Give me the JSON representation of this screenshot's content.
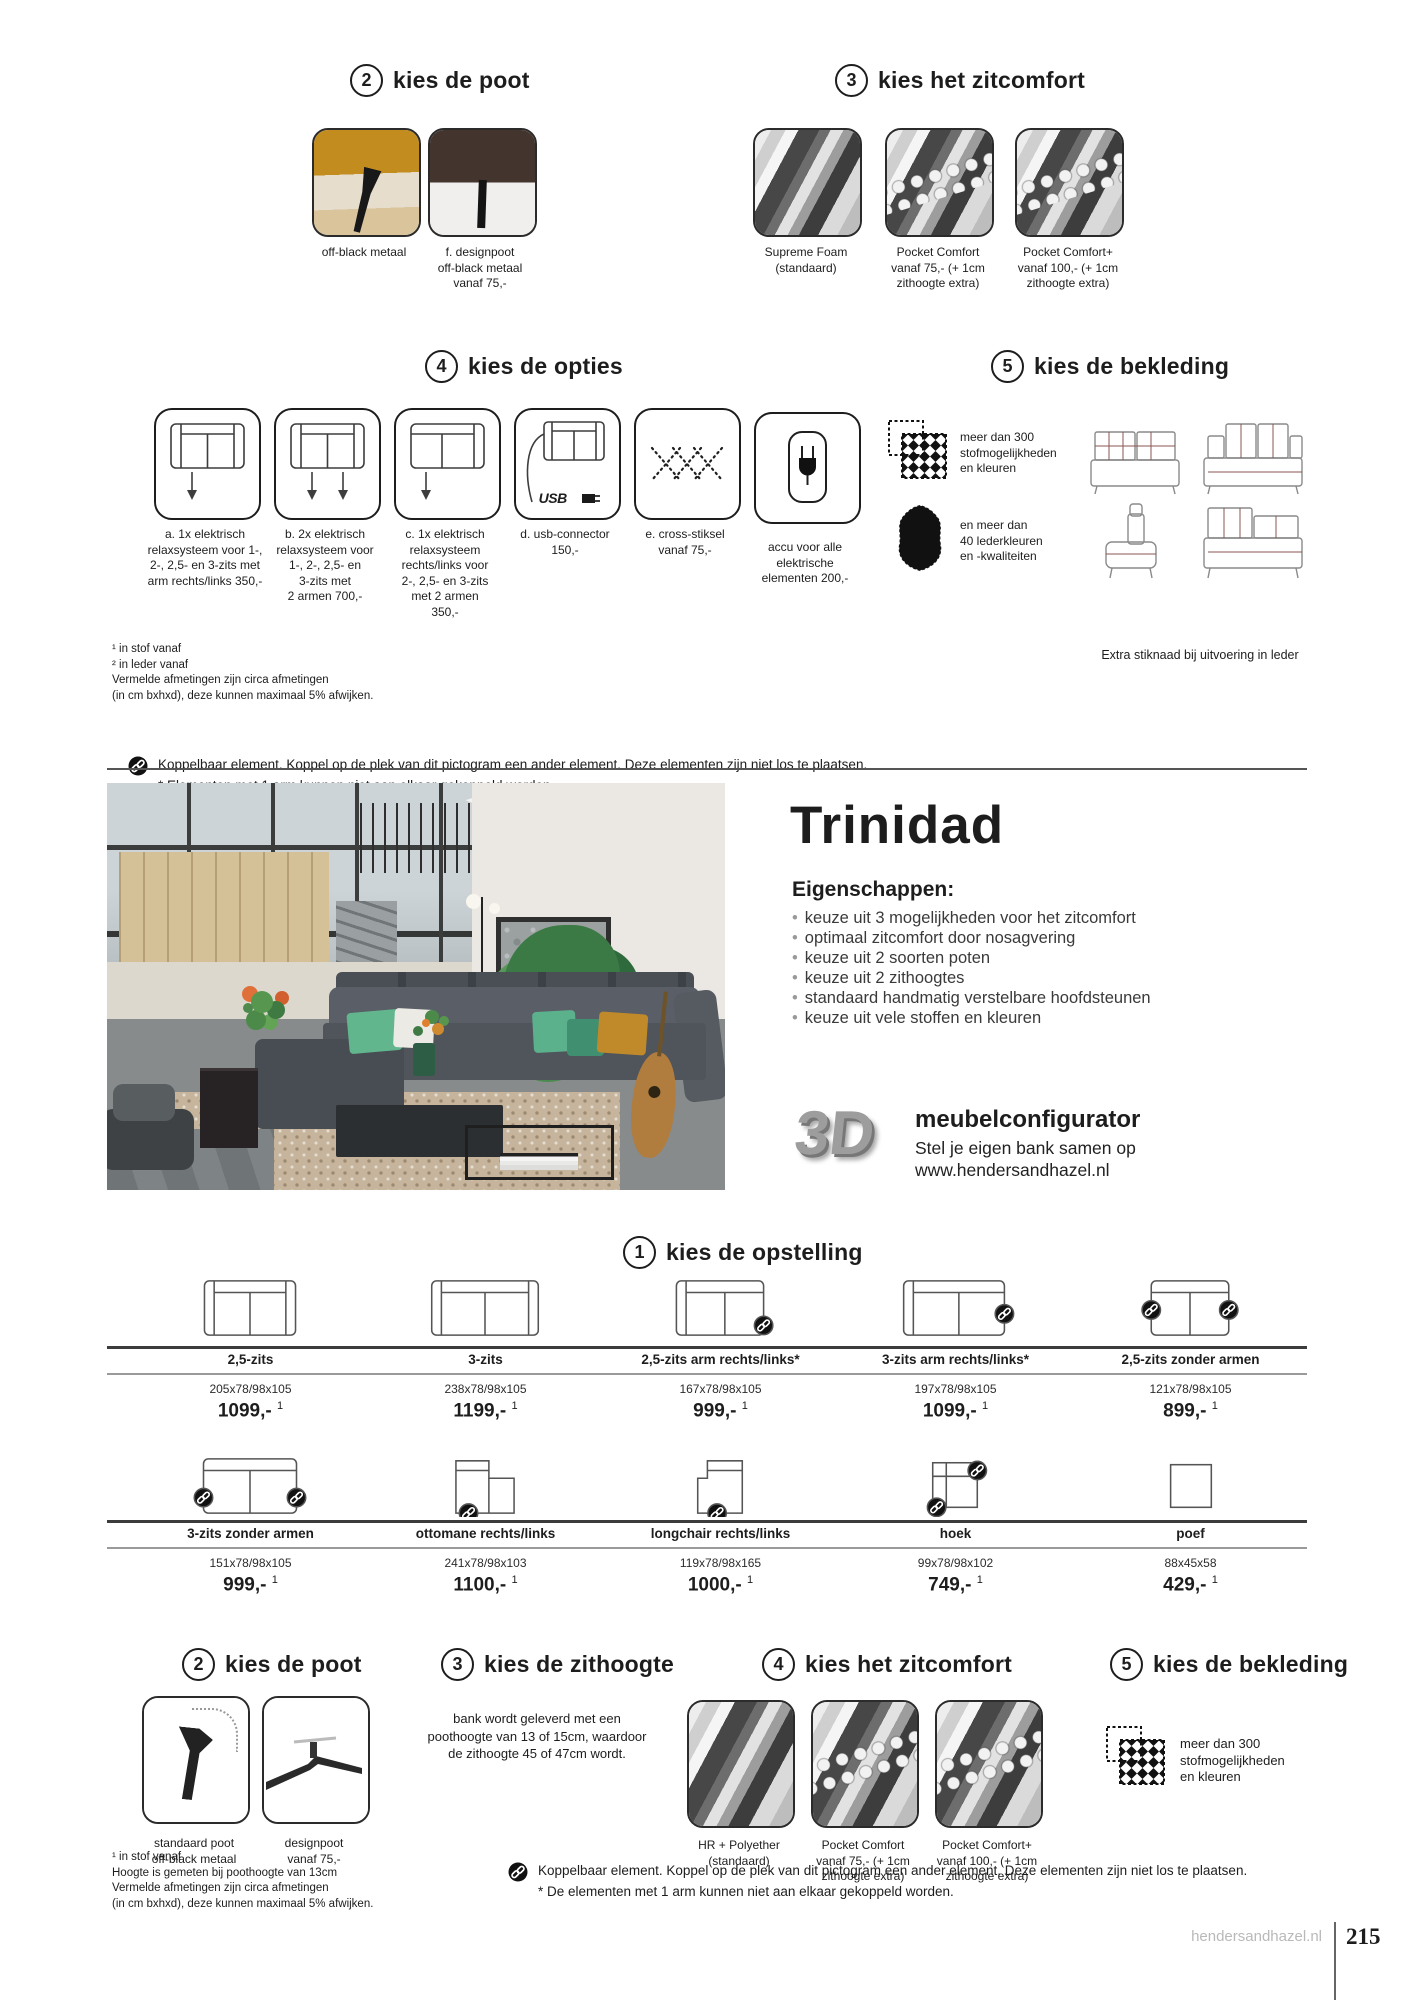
{
  "top_poot": {
    "number": "2",
    "title": "kies de poot",
    "items": [
      {
        "label": "off-black metaal"
      },
      {
        "label": "f. designpoot\noff-black metaal\nvanaf 75,-"
      }
    ]
  },
  "top_comfort": {
    "number": "3",
    "title": "kies het zitcomfort",
    "items": [
      {
        "label": "Supreme Foam\n(standaard)"
      },
      {
        "label": "Pocket Comfort\nvanaf 75,- (+ 1cm\nzithoogte extra)"
      },
      {
        "label": "Pocket Comfort+\nvanaf 100,- (+ 1cm\nzithoogte extra)"
      }
    ]
  },
  "opties": {
    "number": "4",
    "title": "kies de opties",
    "usb_text": "USB",
    "items": [
      {
        "label": "a. 1x elektrisch\nrelaxsysteem voor 1-,\n2-, 2,5- en 3-zits met\narm rechts/links 350,-"
      },
      {
        "label": "b. 2x elektrisch\nrelaxsysteem voor\n1-, 2-, 2,5- en\n3-zits met\n2 armen 700,-"
      },
      {
        "label": "c. 1x elektrisch\nrelaxsysteem\nrechts/links voor\n2-, 2,5- en 3-zits\nmet 2 armen\n350,-"
      },
      {
        "label": "d. usb-connector\n150,-"
      },
      {
        "label": "e. cross-stiksel\nvanaf 75,-"
      },
      {
        "label": "accu voor alle\nelektrische\nelementen 200,-"
      }
    ]
  },
  "bekleding_top": {
    "number": "5",
    "title": "kies de bekleding",
    "fabric_text": "meer dan 300\nstofmogelijkheden\nen kleuren",
    "leather_text": "en meer dan\n40 lederkleuren\nen -kwaliteiten",
    "stitch_note": "Extra stiknaad bij uitvoering in leder"
  },
  "footnotes_top": "¹ in stof vanaf\n² in leder vanaf\nVermelde afmetingen zijn circa afmetingen\n(in cm bxhxd), deze kunnen maximaal 5% afwijken.",
  "koppelbaar_top": {
    "line1": "Koppelbaar element. Koppel op de plek van dit pictogram een ander element. Deze elementen zijn niet los te plaatsen.",
    "line2": "* Elementen met 1 arm kunnen niet aan elkaar gekoppeld worden."
  },
  "product": {
    "name": "Trinidad",
    "features_title": "Eigenschappen:",
    "features": [
      "keuze uit 3 mogelijkheden voor het zitcomfort",
      "optimaal zitcomfort door nosagvering",
      "keuze uit 2 soorten poten",
      "keuze uit 2 zithoogtes",
      "standaard handmatig verstelbare hoofdsteunen",
      "keuze uit vele stoffen en kleuren"
    ],
    "configurator": {
      "logo": "3D",
      "title": "meubelconfigurator",
      "line1": "Stel je eigen bank samen op",
      "line2": "www.hendersandhazel.nl"
    }
  },
  "opstelling": {
    "number": "1",
    "title": "kies de opstelling",
    "row1": [
      {
        "name": "2,5-zits",
        "dim": "205x78/98x105",
        "price": "1099,-",
        "sup": "1"
      },
      {
        "name": "3-zits",
        "dim": "238x78/98x105",
        "price": "1199,-",
        "sup": "1"
      },
      {
        "name": "2,5-zits arm rechts/links*",
        "dim": "167x78/98x105",
        "price": "999,-",
        "sup": "1"
      },
      {
        "name": "3-zits arm rechts/links*",
        "dim": "197x78/98x105",
        "price": "1099,-",
        "sup": "1"
      },
      {
        "name": "2,5-zits zonder armen",
        "dim": "121x78/98x105",
        "price": "899,-",
        "sup": "1"
      }
    ],
    "row2": [
      {
        "name": "3-zits zonder armen",
        "dim": "151x78/98x105",
        "price": "999,-",
        "sup": "1"
      },
      {
        "name": "ottomane rechts/links",
        "dim": "241x78/98x103",
        "price": "1100,-",
        "sup": "1"
      },
      {
        "name": "longchair rechts/links",
        "dim": "119x78/98x165",
        "price": "1000,-",
        "sup": "1"
      },
      {
        "name": "hoek",
        "dim": "99x78/98x102",
        "price": "749,-",
        "sup": "1"
      },
      {
        "name": "poef",
        "dim": "88x45x58",
        "price": "429,-",
        "sup": "1"
      }
    ]
  },
  "bottom_poot": {
    "number": "2",
    "title": "kies de poot",
    "items": [
      {
        "label": "standaard poot\noff-black metaal"
      },
      {
        "label": "designpoot\nvanaf 75,-"
      }
    ]
  },
  "zithoogte": {
    "number": "3",
    "title": "kies de zithoogte",
    "text": "bank wordt geleverd met een\npoothoogte van 13 of 15cm, waardoor\nde zithoogte 45 of 47cm wordt."
  },
  "bottom_comfort": {
    "number": "4",
    "title": "kies het zitcomfort",
    "items": [
      {
        "label": "HR + Polyether\n(standaard)"
      },
      {
        "label": "Pocket Comfort\nvanaf 75,- (+ 1cm\nzithoogte extra)"
      },
      {
        "label": "Pocket Comfort+\nvanaf 100,- (+ 1cm\nzithoogte extra)"
      }
    ]
  },
  "bekleding_bottom": {
    "number": "5",
    "title": "kies de bekleding",
    "fabric_text": "meer dan 300\nstofmogelijkheden\nen kleuren"
  },
  "footnotes_bottom": "¹ in stof vanaf\nHoogte is gemeten bij poothoogte van 13cm\nVermelde afmetingen zijn circa afmetingen\n(in cm bxhxd), deze kunnen maximaal 5% afwijken.",
  "koppelbaar_bottom": {
    "line1": "Koppelbaar element. Koppel op de plek van dit pictogram een ander element. Deze elementen zijn niet los te plaatsen.",
    "line2": "* De elementen met 1 arm kunnen niet aan elkaar gekoppeld worden."
  },
  "footer": {
    "site": "hendersandhazel.nl",
    "page": "215"
  }
}
